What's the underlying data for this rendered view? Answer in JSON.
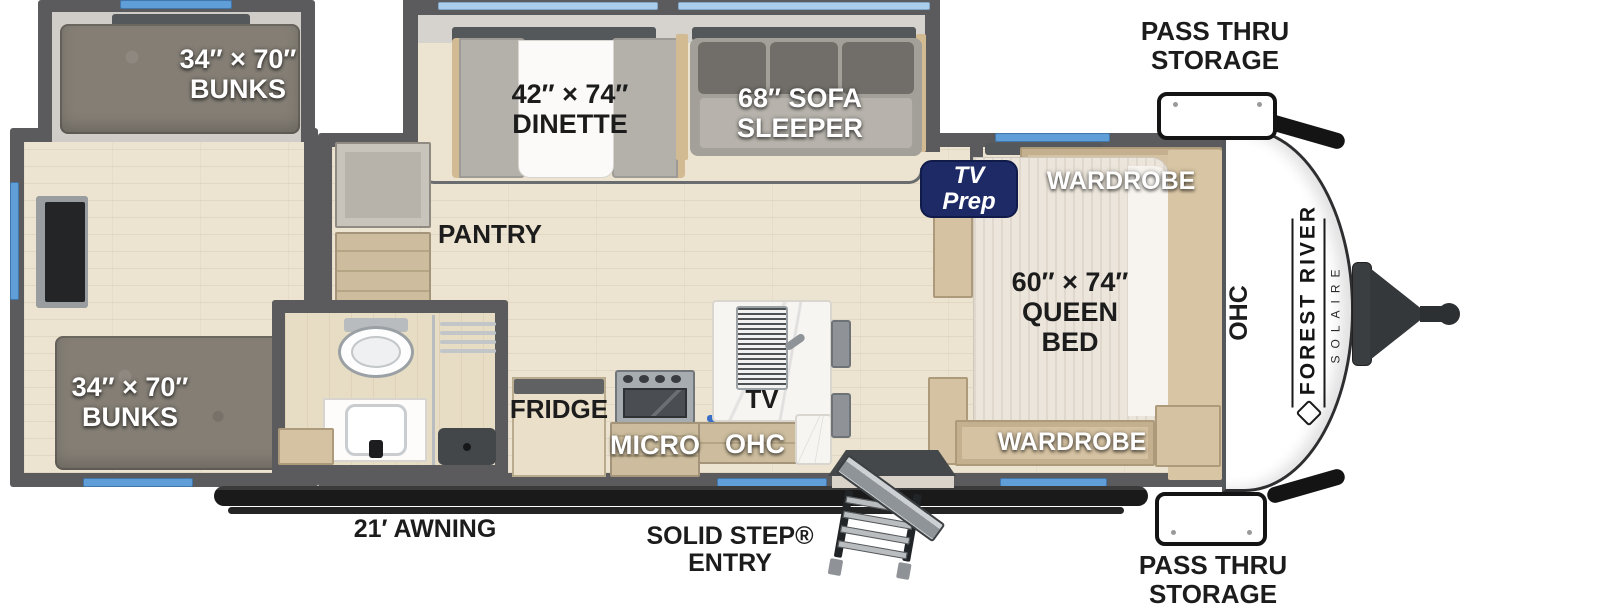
{
  "rooms": {
    "bunk_top": {
      "size": "34″ × 70″",
      "name": "BUNKS"
    },
    "bunk_bottom": {
      "size": "34″ × 70″",
      "name": "BUNKS"
    },
    "dinette": {
      "size": "42″ × 74″",
      "name": "DINETTE"
    },
    "sofa": {
      "line1": "68″ SOFA",
      "line2": "SLEEPER"
    },
    "pantry": "PANTRY",
    "queen_bed": {
      "size": "60″ × 74″",
      "line2": "QUEEN",
      "line3": "BED"
    },
    "wardrobe_top": "WARDROBE",
    "wardrobe_bottom": "WARDROBE",
    "tv_prep": {
      "line1": "TV",
      "line2": "Prep"
    },
    "fridge": "FRIDGE",
    "micro": "MICRO",
    "ohc_kitchen": "OHC",
    "ohc_front": "OHC",
    "tv_island": "TV"
  },
  "annotations": {
    "pass_thru_top": {
      "line1": "PASS THRU",
      "line2": "STORAGE"
    },
    "pass_thru_bottom": {
      "line1": "PASS THRU",
      "line2": "STORAGE"
    },
    "awning": "21′ AWNING",
    "solid_step": {
      "line1": "SOLID STEP®",
      "line2": "ENTRY"
    }
  },
  "brand": {
    "name": "FOREST RIVER",
    "model": "SOLAIRE"
  },
  "colors": {
    "wall": "#5b5b5d",
    "floor": "#ece3d0",
    "window_blue": "#5f9ed6",
    "window_light_blue": "#aacdeb",
    "navy_badge": "#1d2a66",
    "awning_black": "#1a1a1a",
    "cabinet_tan": "#d5c2a2"
  }
}
